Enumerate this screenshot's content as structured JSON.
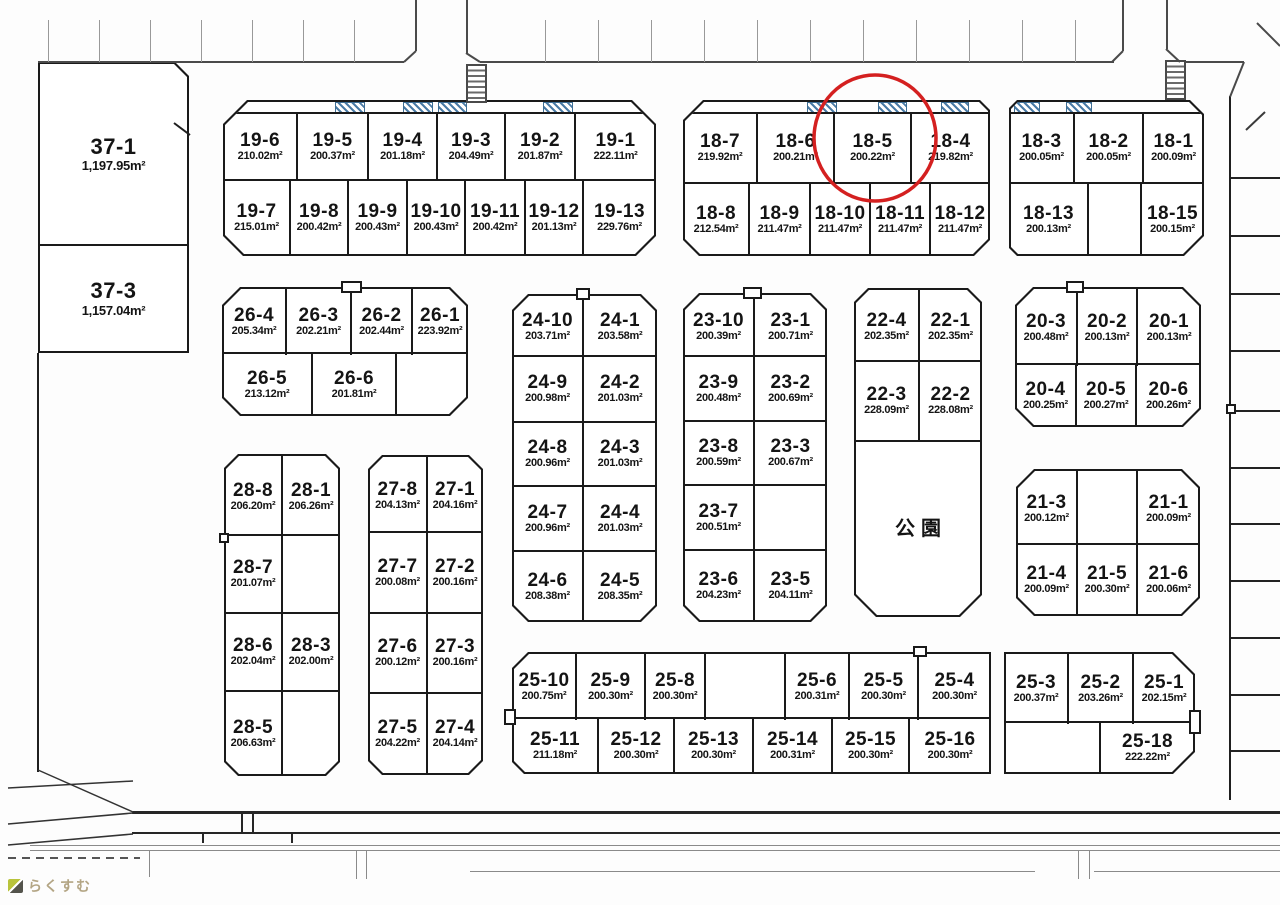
{
  "map": {
    "background": "#fdfdfd",
    "highlight": {
      "lot": "18-5",
      "color": "#d42020"
    },
    "logo": {
      "text": "らくすむ"
    },
    "park_label": "公園",
    "blocks": {
      "37": [
        [
          {
            "no": "37-1",
            "area": "1,197.95m²"
          }
        ],
        [
          {
            "no": "37-3",
            "area": "1,157.04m²"
          }
        ]
      ],
      "19": [
        [
          {
            "no": "19-6",
            "area": "210.02m²"
          },
          {
            "no": "19-5",
            "area": "200.37m²"
          },
          {
            "no": "19-4",
            "area": "201.18m²"
          },
          {
            "no": "19-3",
            "area": "204.49m²"
          },
          {
            "no": "19-2",
            "area": "201.87m²"
          },
          {
            "no": "19-1",
            "area": "222.11m²"
          }
        ],
        [
          {
            "no": "19-7",
            "area": "215.01m²"
          },
          {
            "no": "19-8",
            "area": "200.42m²"
          },
          {
            "no": "19-9",
            "area": "200.43m²"
          },
          {
            "no": "19-10",
            "area": "200.43m²"
          },
          {
            "no": "19-11",
            "area": "200.42m²"
          },
          {
            "no": "19-12",
            "area": "201.13m²"
          },
          {
            "no": "19-13",
            "area": "229.76m²"
          }
        ]
      ],
      "18L": [
        [
          {
            "no": "18-7",
            "area": "219.92m²"
          },
          {
            "no": "18-6",
            "area": "200.21m²"
          },
          {
            "no": "18-5",
            "area": "200.22m²"
          },
          {
            "no": "18-4",
            "area": "219.82m²"
          }
        ],
        [
          {
            "no": "18-8",
            "area": "212.54m²"
          },
          {
            "no": "18-9",
            "area": "211.47m²"
          },
          {
            "no": "18-10",
            "area": "211.47m²"
          },
          {
            "no": "18-11",
            "area": "211.47m²"
          },
          {
            "no": "18-12",
            "area": "211.47m²"
          }
        ]
      ],
      "18R": [
        [
          {
            "no": "18-3",
            "area": "200.05m²"
          },
          {
            "no": "18-2",
            "area": "200.05m²"
          },
          {
            "no": "18-1",
            "area": "200.09m²"
          }
        ],
        [
          {
            "no": "18-13",
            "area": "200.13m²"
          },
          null,
          {
            "no": "18-15",
            "area": "200.15m²"
          }
        ]
      ],
      "26": [
        [
          {
            "no": "26-4",
            "area": "205.34m²"
          },
          {
            "no": "26-3",
            "area": "202.21m²"
          },
          {
            "no": "26-2",
            "area": "202.44m²"
          },
          {
            "no": "26-1",
            "area": "223.92m²"
          }
        ],
        [
          {
            "no": "26-5",
            "area": "213.12m²"
          },
          {
            "no": "26-6",
            "area": "201.81m²"
          },
          null
        ]
      ],
      "24": [
        [
          {
            "no": "24-10",
            "area": "203.71m²"
          },
          {
            "no": "24-1",
            "area": "203.58m²"
          }
        ],
        [
          {
            "no": "24-9",
            "area": "200.98m²"
          },
          {
            "no": "24-2",
            "area": "201.03m²"
          }
        ],
        [
          {
            "no": "24-8",
            "area": "200.96m²"
          },
          {
            "no": "24-3",
            "area": "201.03m²"
          }
        ],
        [
          {
            "no": "24-7",
            "area": "200.96m²"
          },
          {
            "no": "24-4",
            "area": "201.03m²"
          }
        ],
        [
          {
            "no": "24-6",
            "area": "208.38m²"
          },
          {
            "no": "24-5",
            "area": "208.35m²"
          }
        ]
      ],
      "23": [
        [
          {
            "no": "23-10",
            "area": "200.39m²"
          },
          {
            "no": "23-1",
            "area": "200.71m²"
          }
        ],
        [
          {
            "no": "23-9",
            "area": "200.48m²"
          },
          {
            "no": "23-2",
            "area": "200.69m²"
          }
        ],
        [
          {
            "no": "23-8",
            "area": "200.59m²"
          },
          {
            "no": "23-3",
            "area": "200.67m²"
          }
        ],
        [
          {
            "no": "23-7",
            "area": "200.51m²"
          },
          null
        ],
        [
          {
            "no": "23-6",
            "area": "204.23m²"
          },
          {
            "no": "23-5",
            "area": "204.11m²"
          }
        ]
      ],
      "22": [
        [
          {
            "no": "22-4",
            "area": "202.35m²"
          },
          {
            "no": "22-1",
            "area": "202.35m²"
          }
        ],
        [
          {
            "no": "22-3",
            "area": "228.09m²"
          },
          {
            "no": "22-2",
            "area": "228.08m²"
          }
        ],
        [
          {
            "no": "公園",
            "area": ""
          }
        ]
      ],
      "20": [
        [
          {
            "no": "20-3",
            "area": "200.48m²"
          },
          {
            "no": "20-2",
            "area": "200.13m²"
          },
          {
            "no": "20-1",
            "area": "200.13m²"
          }
        ],
        [
          {
            "no": "20-4",
            "area": "200.25m²"
          },
          {
            "no": "20-5",
            "area": "200.27m²"
          },
          {
            "no": "20-6",
            "area": "200.26m²"
          }
        ]
      ],
      "21": [
        [
          {
            "no": "21-3",
            "area": "200.12m²"
          },
          null,
          {
            "no": "21-1",
            "area": "200.09m²"
          }
        ],
        [
          {
            "no": "21-4",
            "area": "200.09m²"
          },
          {
            "no": "21-5",
            "area": "200.30m²"
          },
          {
            "no": "21-6",
            "area": "200.06m²"
          }
        ]
      ],
      "28": [
        [
          {
            "no": "28-8",
            "area": "206.20m²"
          },
          {
            "no": "28-1",
            "area": "206.26m²"
          }
        ],
        [
          {
            "no": "28-7",
            "area": "201.07m²"
          },
          null
        ],
        [
          {
            "no": "28-6",
            "area": "202.04m²"
          },
          {
            "no": "28-3",
            "area": "202.00m²"
          }
        ],
        [
          {
            "no": "28-5",
            "area": "206.63m²"
          },
          null
        ]
      ],
      "27": [
        [
          {
            "no": "27-8",
            "area": "204.13m²"
          },
          {
            "no": "27-1",
            "area": "204.16m²"
          }
        ],
        [
          {
            "no": "27-7",
            "area": "200.08m²"
          },
          {
            "no": "27-2",
            "area": "200.16m²"
          }
        ],
        [
          {
            "no": "27-6",
            "area": "200.12m²"
          },
          {
            "no": "27-3",
            "area": "200.16m²"
          }
        ],
        [
          {
            "no": "27-5",
            "area": "204.22m²"
          },
          {
            "no": "27-4",
            "area": "204.14m²"
          }
        ]
      ],
      "25L": [
        [
          {
            "no": "25-10",
            "area": "200.75m²"
          },
          {
            "no": "25-9",
            "area": "200.30m²"
          },
          {
            "no": "25-8",
            "area": "200.30m²"
          },
          null,
          {
            "no": "25-6",
            "area": "200.31m²"
          },
          {
            "no": "25-5",
            "area": "200.30m²"
          },
          {
            "no": "25-4",
            "area": "200.30m²"
          }
        ],
        [
          {
            "no": "25-11",
            "area": "211.18m²"
          },
          {
            "no": "25-12",
            "area": "200.30m²"
          },
          {
            "no": "25-13",
            "area": "200.30m²"
          },
          {
            "no": "25-14",
            "area": "200.31m²"
          },
          {
            "no": "25-15",
            "area": "200.30m²"
          },
          {
            "no": "25-16",
            "area": "200.30m²"
          }
        ]
      ],
      "25R": [
        [
          {
            "no": "25-3",
            "area": "200.37m²"
          },
          {
            "no": "25-2",
            "area": "203.26m²"
          },
          {
            "no": "25-1",
            "area": "202.15m²"
          }
        ],
        [
          null,
          {
            "no": "25-18",
            "area": "222.22m²"
          }
        ]
      ]
    }
  }
}
